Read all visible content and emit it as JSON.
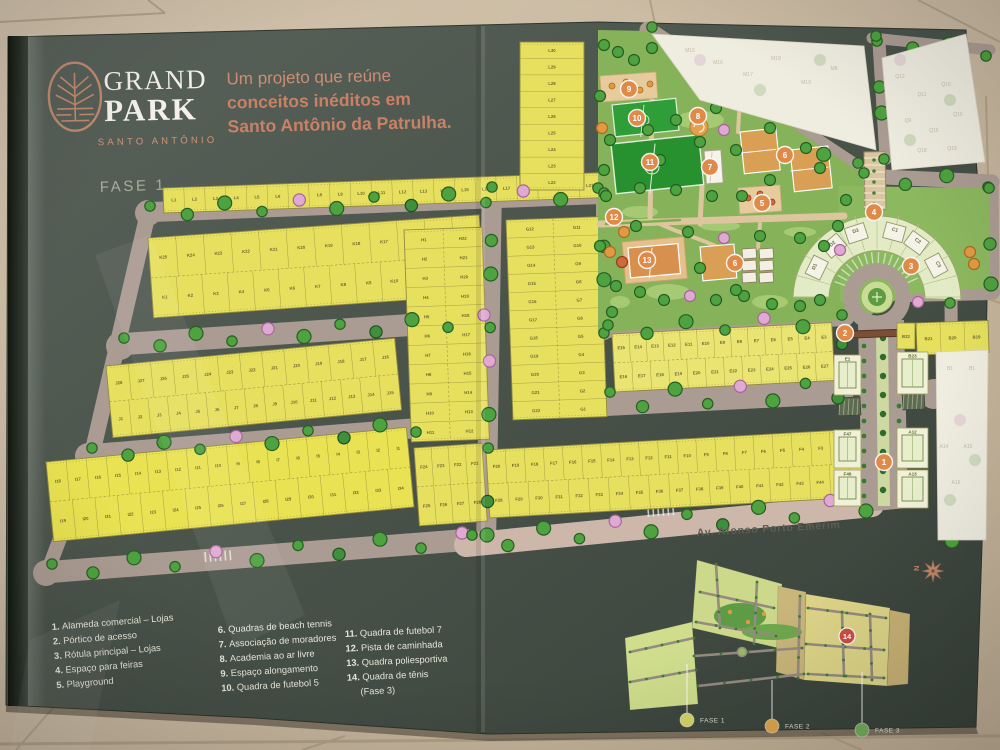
{
  "brand": {
    "name_line1": "GRAND",
    "name_line2": "PARK",
    "subtitle": "SANTO ANTÔNIO"
  },
  "headline": {
    "line1": "Um projeto que reúne",
    "line2": "conceitos inéditos em",
    "line3": "Santo Antônio da Patrulha."
  },
  "phase_label": "FASE 1",
  "avenue_label": "Av. Afonso Porto Emerim",
  "legend": {
    "columns": [
      [
        {
          "n": "1.",
          "label": "Alameda comercial – Lojas"
        },
        {
          "n": "2.",
          "label": "Pórtico de acesso"
        },
        {
          "n": "3.",
          "label": "Rótula principal – Lojas"
        },
        {
          "n": "4.",
          "label": "Espaço para feiras"
        },
        {
          "n": "5.",
          "label": "Playground"
        }
      ],
      [
        {
          "n": "6.",
          "label": "Quadras de beach tennis"
        },
        {
          "n": "7.",
          "label": "Associação de moradores"
        },
        {
          "n": "8.",
          "label": "Academia ao ar livre"
        },
        {
          "n": "9.",
          "label": "Espaço alongamento"
        },
        {
          "n": "10.",
          "label": "Quadra de futebol 5"
        }
      ],
      [
        {
          "n": "11.",
          "label": "Quadra de futebol 7"
        },
        {
          "n": "12.",
          "label": "Pista de caminhada"
        },
        {
          "n": "13.",
          "label": "Quadra poliesportiva"
        },
        {
          "n": "14.",
          "label": "Quadra de tênis",
          "label2": "(Fase 3)"
        }
      ]
    ]
  },
  "map": {
    "lot_blocks": [
      {
        "id": "L-row",
        "prefix": "L",
        "from": 1,
        "to": 21
      },
      {
        "id": "L-col",
        "prefix": "L",
        "from": 30,
        "to": 22
      },
      {
        "id": "K-top",
        "prefix": "K",
        "from": 25,
        "to": 14
      },
      {
        "id": "K-bottom",
        "prefix": "K",
        "from": 1,
        "to": 13
      },
      {
        "id": "H-left",
        "prefix": "H",
        "from": 1,
        "to": 11
      },
      {
        "id": "H-right",
        "prefix": "H",
        "from": 22,
        "to": 12
      },
      {
        "id": "J-top",
        "prefix": "J",
        "from": 28,
        "to": 16
      },
      {
        "id": "J-bottom",
        "prefix": "J",
        "from": 1,
        "to": 15
      },
      {
        "id": "I-top",
        "prefix": "I",
        "from": 18,
        "to": 1
      },
      {
        "id": "I-bottom",
        "prefix": "I",
        "from": 19,
        "to": 34
      },
      {
        "id": "G-left",
        "prefix": "G",
        "from": 12,
        "to": 22
      },
      {
        "id": "G-right",
        "prefix": "G",
        "from": 11,
        "to": 1
      },
      {
        "id": "E-top",
        "prefix": "E",
        "from": 15,
        "to": 3
      },
      {
        "id": "E-bottom",
        "prefix": "E",
        "from": 16,
        "to": 27
      },
      {
        "id": "F-sub-top",
        "prefix": "F",
        "from": 24,
        "to": 21
      },
      {
        "id": "F-sub-bottom",
        "prefix": "F",
        "from": 25,
        "to": 28
      },
      {
        "id": "F-top",
        "prefix": "F",
        "from": 20,
        "to": 1
      },
      {
        "id": "F-bottom",
        "prefix": "F",
        "from": 28,
        "to": 46
      },
      {
        "id": "B-row",
        "lots": [
          "B21",
          "B20",
          "B19"
        ]
      }
    ],
    "commercial_lots": [
      "D1",
      "D2",
      "D3",
      "C1",
      "C2",
      "C3"
    ],
    "building_lots": [
      "E1",
      "F47",
      "F46",
      "B23",
      "A12",
      "A13"
    ],
    "small_lot": "B22",
    "ghost_labels_m": [
      "M15",
      "M16",
      "M17",
      "M18",
      "M19",
      "M8"
    ],
    "ghost_labels_q": [
      "Q12",
      "Q11",
      "Q10",
      "Q9",
      "Q16",
      "Q15",
      "Q18",
      "Q19"
    ],
    "ghost_labels_ab": [
      "B1",
      "B1",
      "A14",
      "A15",
      "A16"
    ]
  },
  "mini_map": {
    "marker": "14",
    "compass": "N",
    "phases": [
      {
        "label": "FASE 1",
        "color": "#d4d66a"
      },
      {
        "label": "FASE 2",
        "color": "#dfa84e"
      },
      {
        "label": "FASE 3",
        "color": "#74ac5c"
      }
    ]
  },
  "colors": {
    "brochure_green": "#48524a",
    "logo_copper": "#c08a6e",
    "headline_copper": "#cb8166",
    "lot_yellow": "#e6e05e",
    "road_gray": "#ab9c93",
    "avenue_pink": "#cdb6aa",
    "tree_green": "#4ea23f",
    "tree_pink": "#dfaad2",
    "field_green": "#2f9e38",
    "court_orange": "#d9a055",
    "marker_orange": "#e08a4a",
    "marker_red": "#cc4f43",
    "tile_beige": "#c9baa3"
  }
}
